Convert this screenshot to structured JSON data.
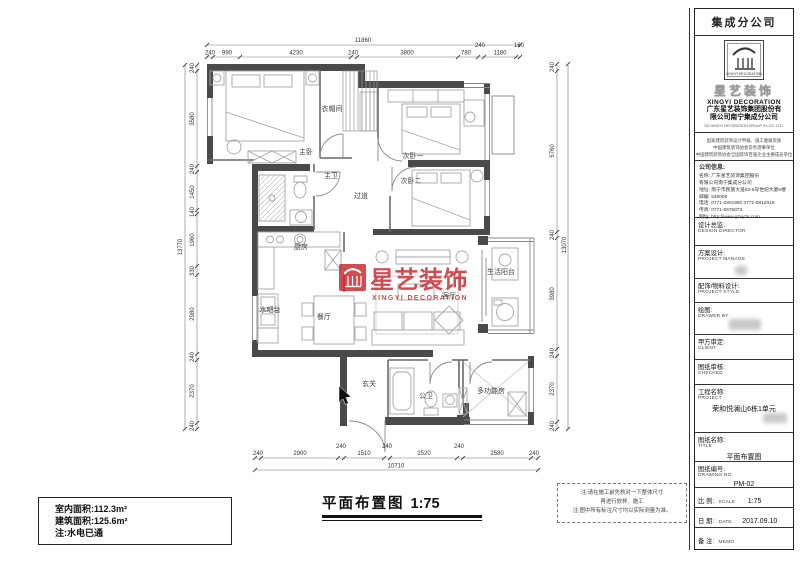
{
  "watermark": {
    "cn": "星艺装饰",
    "en": "XINGYI DECORATION"
  },
  "plan": {
    "rooms": [
      "主卧",
      "衣帽间",
      "次卧一",
      "次卧二",
      "主卫",
      "过道",
      "厨房",
      "水吧台",
      "餐厅",
      "客厅",
      "生活阳台",
      "玄关",
      "公卫",
      "多功能房"
    ],
    "dims": {
      "top": {
        "overall": "11860",
        "segs": [
          "240",
          "990",
          "4230",
          "240",
          "3800",
          "780",
          "240",
          "1180",
          "160"
        ]
      },
      "bottom": {
        "overall": "10710",
        "segs": [
          "240",
          "2900",
          "240",
          "1510",
          "240",
          "2520",
          "240",
          "2580",
          "240"
        ]
      },
      "left": {
        "overall": "13770",
        "segs": [
          "240",
          "3580",
          "240",
          "1450",
          "140",
          "1960",
          "330",
          "2980",
          "240",
          "2370",
          "240"
        ]
      },
      "right": {
        "overall": "13070",
        "segs": [
          "240",
          "5760",
          "240",
          "3980",
          "240",
          "2370",
          "240"
        ]
      }
    }
  },
  "footer": {
    "area_line1": "室内面积:112.3m²",
    "area_line2": "建筑面积:125.6m²",
    "area_line3": "注:水电已通",
    "title": "平面布置图",
    "scale": "1:75",
    "note1": "注:请在施工前先核对一下整体尺寸",
    "note2": "再进行放样、施工",
    "note3": "注:图中所有标注尺寸均以实际测量为准。"
  },
  "titleblock": {
    "branch": "集成分公司",
    "logo": {
      "cn": "星艺装饰",
      "en": "XINGYI DECORATION",
      "co1": "广东星艺装饰集团股份有",
      "co2": "限公司南宁集成分公司",
      "co_en": "GD.XINGYI DECORATION GROUP SX CO.,LTD."
    },
    "creds": [
      "国家建筑装饰设计甲级、施工壹级资质",
      "中国建筑装饰协会常务理事单位",
      "中国建筑装饰协会全国装饰百强企业主要成员单位"
    ],
    "info": {
      "heading": "公司信息:",
      "line0": "名称: 广东星艺装饰集团股份",
      "line1": "有限公司南宁集成分公司",
      "line2": "地址: 南宁市民族大道63-5号世纪大厦5楼",
      "line3": "邮编: 530000",
      "line4": "电话: 0771-2801992  0771-5812019",
      "line5": "传真: 0771-5575873",
      "line6": "网址: http://www.gzxyzs.com"
    },
    "rows": [
      {
        "cn": "设计总监:",
        "en": "DESIGN DIRECTOR",
        "value": ""
      },
      {
        "cn": "方案设计:",
        "en": "PROJECT MANAGE",
        "value": ""
      },
      {
        "cn": "配饰/物料设计:",
        "en": "PROJECT STYLE",
        "value": ""
      },
      {
        "cn": "绘图:",
        "en": "DRAWER BY",
        "value": ""
      },
      {
        "cn": "甲方审定:",
        "en": "CLIENT",
        "value": ""
      },
      {
        "cn": "图纸审核:",
        "en": "CHECKED",
        "value": ""
      },
      {
        "cn": "工程名称:",
        "en": "PROJECT",
        "value": "荣和悦澜山6栋1单元"
      },
      {
        "cn": "图纸名称:",
        "en": "TITLE",
        "value": "平面布置图"
      },
      {
        "cn": "图纸编号:",
        "en": "DRAWING NO.",
        "value": "PM-02"
      },
      {
        "cn": "比 例:",
        "en": "SCALE",
        "value": "1:75"
      },
      {
        "cn": "日 期:",
        "en": "DATE",
        "value": "2017.09.10"
      },
      {
        "cn": "备 注:",
        "en": "MEMO",
        "value": ""
      }
    ]
  },
  "colors": {
    "accent_red": "#c5262c",
    "wall": "#4a4a4a"
  }
}
